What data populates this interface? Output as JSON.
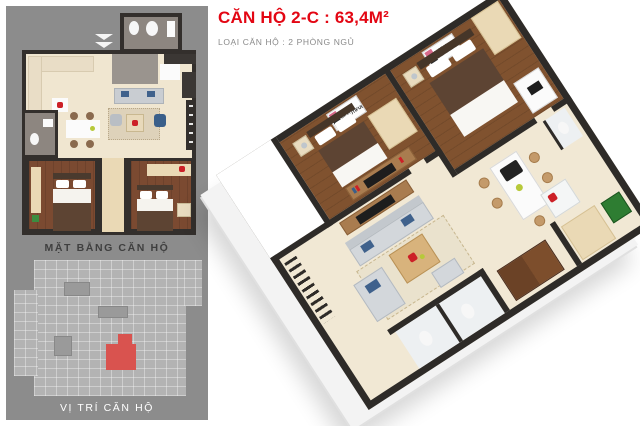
{
  "header": {
    "title": "CĂN HỘ 2-C : 63,4M²",
    "subtitle": "LOẠI CĂN HỘ : 2 PHÒNG NGỦ"
  },
  "sidebar": {
    "plan_caption": "MẶT BẰNG CĂN HỘ",
    "location_caption": "VỊ TRÍ CĂN HỘ"
  },
  "render3d": {
    "poster_bedroom1": "LIFE IS BEAUTIFUL",
    "poster_bedroom2": "LIFE IS BEAUTIFUL"
  },
  "colors": {
    "title_red": "#e30613",
    "subtitle_gray": "#8a8a8a",
    "panel_gray": "#8c8c8c",
    "site_diagram_gray": "#b3b3b3",
    "site_unit_red": "#d9534f",
    "wall_dark": "#2e2b28",
    "wood_floor": "#7b4a31",
    "cream_floor": "#f0e6d0",
    "sofa_gray": "#d3d7db",
    "accent_flower_red": "#cc2027",
    "washer_green": "#2e7d32"
  }
}
